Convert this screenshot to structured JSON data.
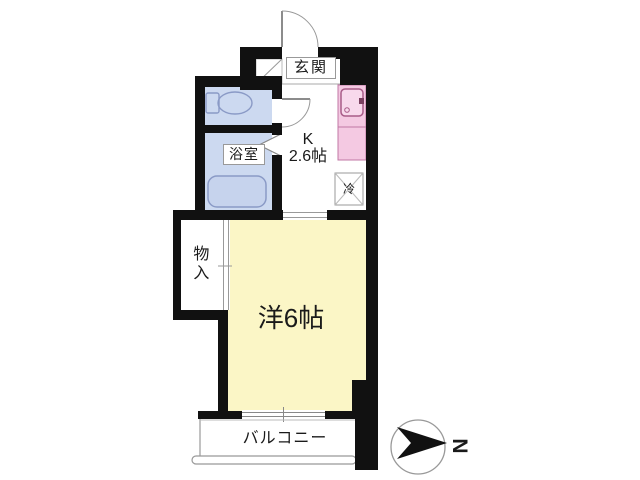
{
  "plan": {
    "type": "floor-plan",
    "rooms": {
      "genkan": {
        "label": "玄関"
      },
      "bathroom": {
        "label": "浴室"
      },
      "kitchen": {
        "label_type": "K",
        "label_size": "2.6帖"
      },
      "refrigerator": {
        "label": "冷"
      },
      "storage": {
        "label": "物入"
      },
      "western_room": {
        "label": "洋6帖"
      },
      "balcony": {
        "label": "バルコニー"
      }
    },
    "compass": {
      "label": "N"
    },
    "colors": {
      "wall": "#111111",
      "wet_area_blue": "#ccd9f0",
      "room_yellow": "#fbf6c6",
      "kitchen_counter_pink": "#f4c9e2",
      "sink_pink": "#f8d9ec",
      "fixture_stroke_blue": "#8a9ac6",
      "fixture_stroke_pink": "#c077a4",
      "line_gray": "#999999"
    }
  }
}
